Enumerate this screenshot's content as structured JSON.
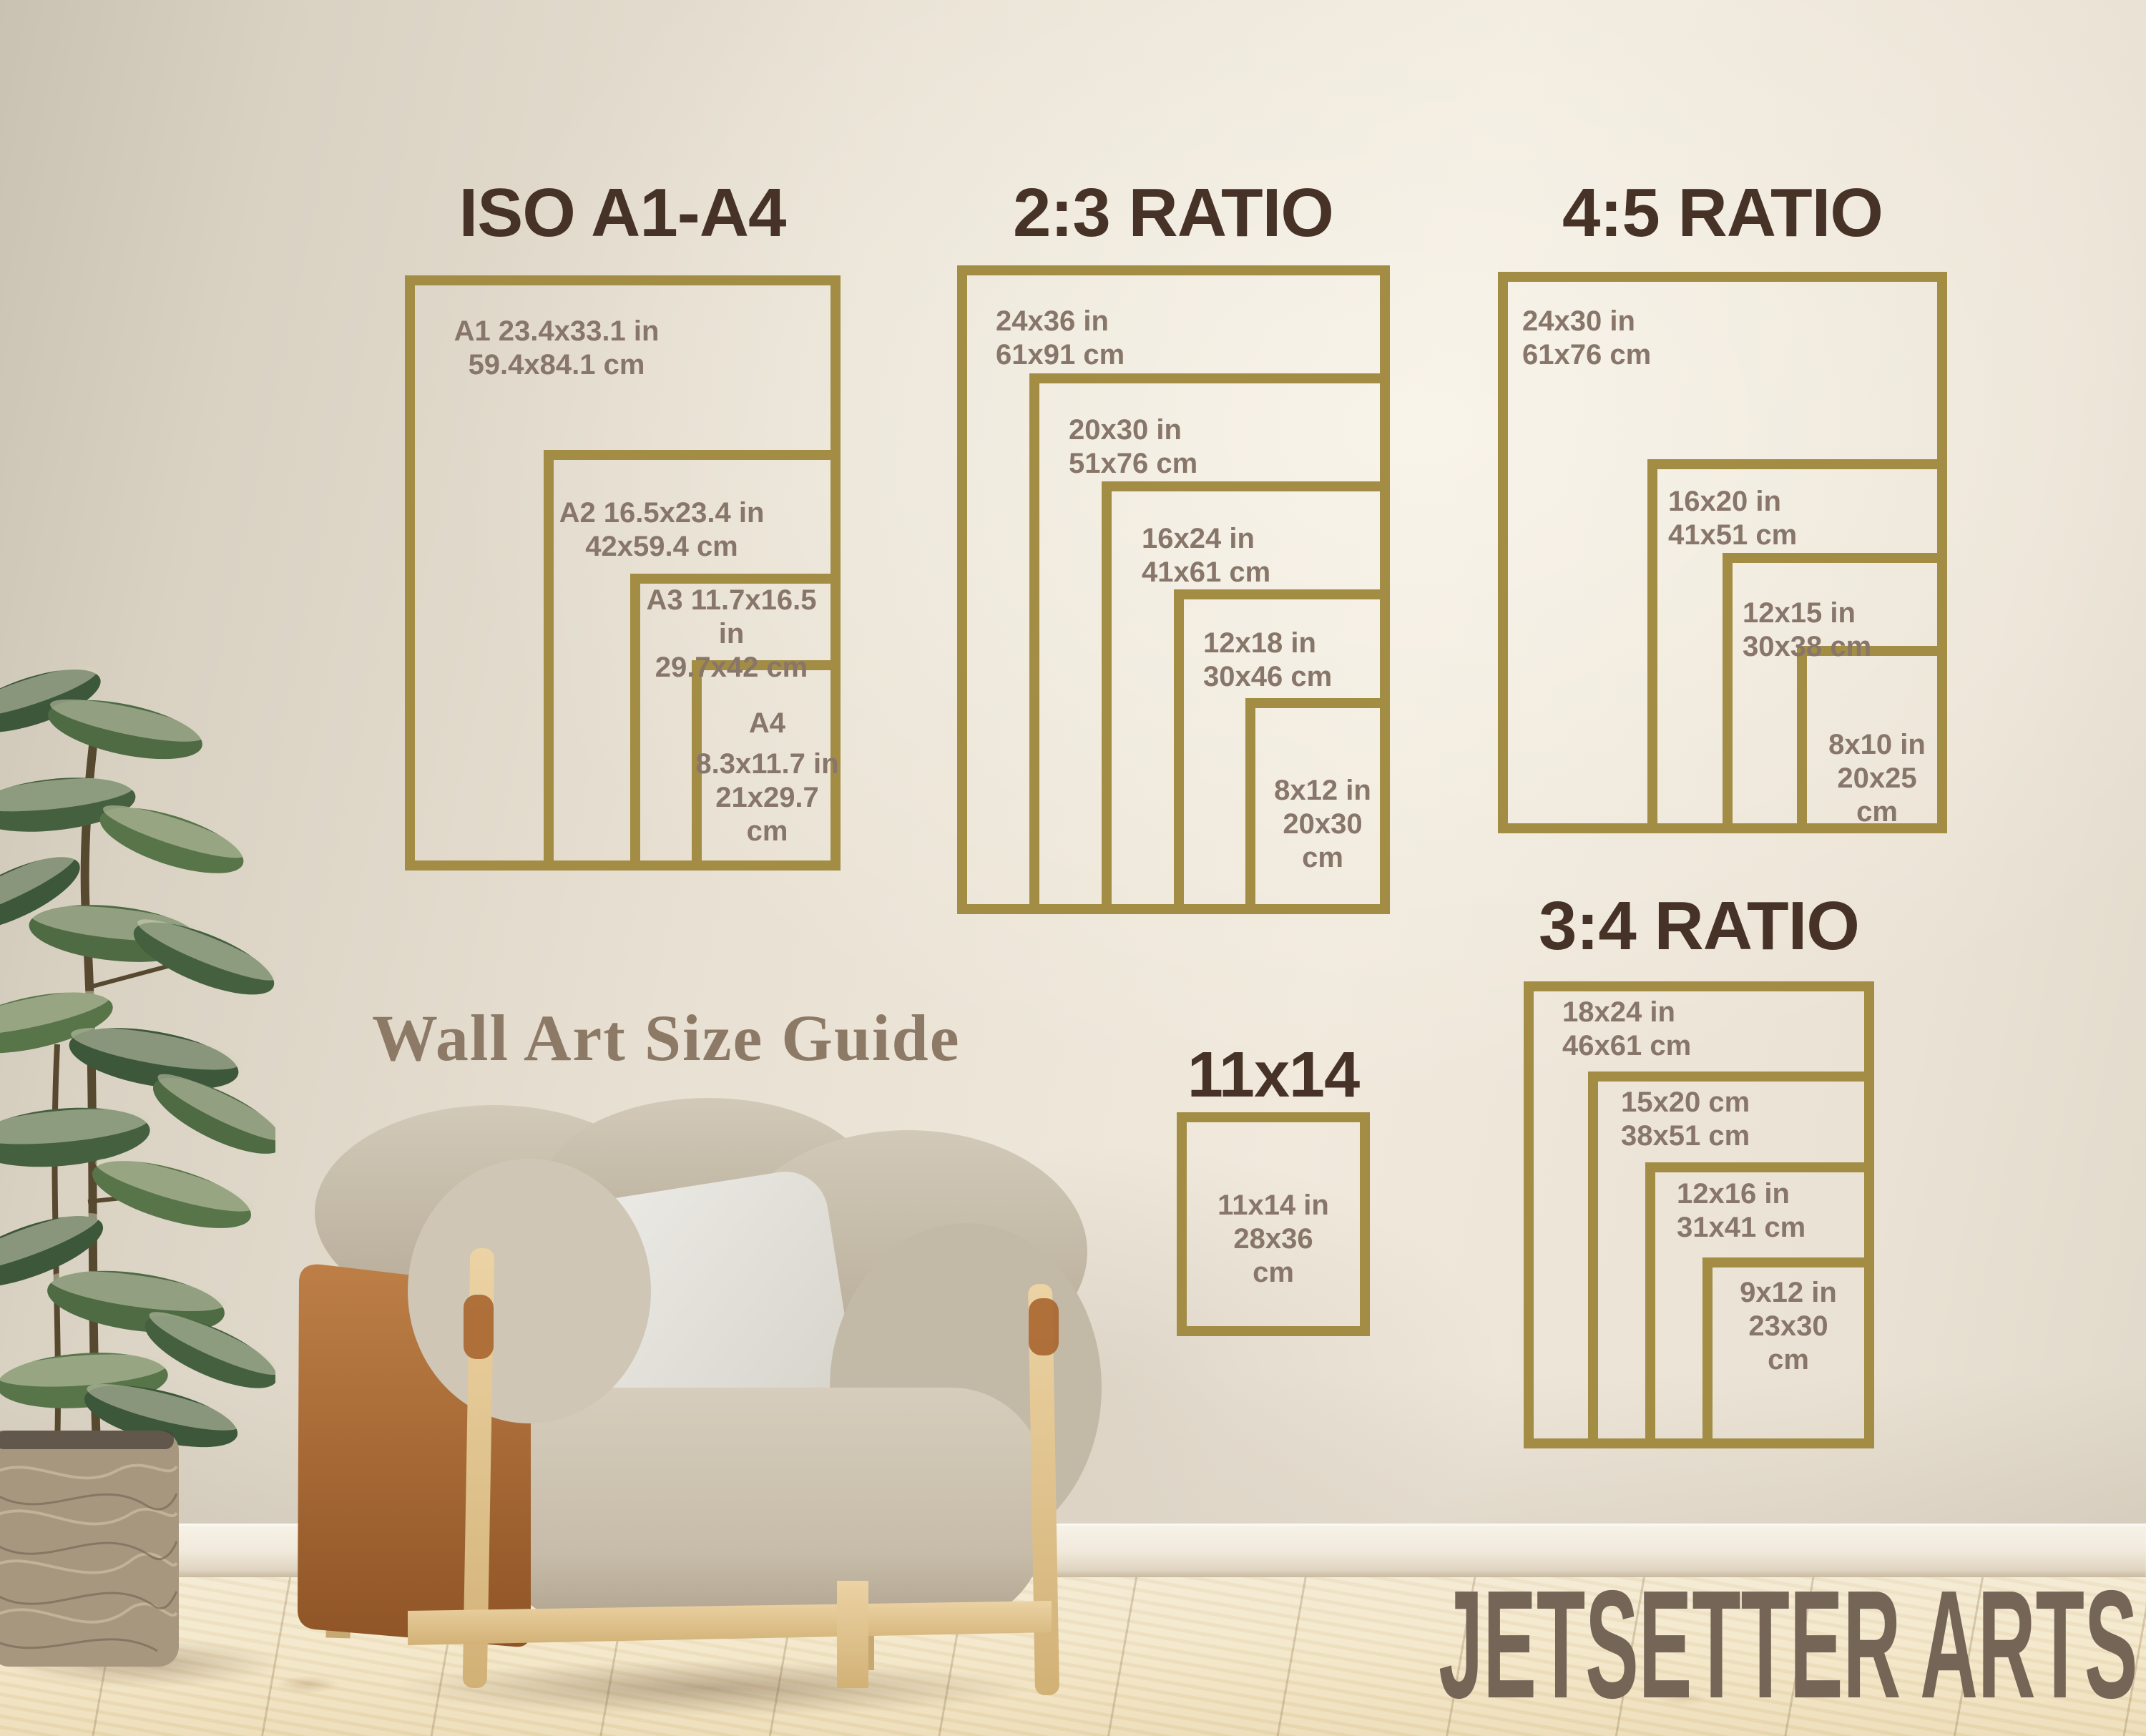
{
  "subtitle": "Wall Art Size Guide",
  "watermark": "JETSETTER ARTS",
  "colors": {
    "frame_gold": "#a38d45",
    "title_brown": "#463226",
    "label_gray_brown": "#877669",
    "subtitle_brown": "#8c7a67",
    "watermark_taupe": "#756557",
    "wall_beige": "#eae3d5",
    "floor_wood": "#f0e2c2",
    "leather_tan": "#b5723c",
    "chair_fabric": "#cbc2b1",
    "plant_green": "#44603f"
  },
  "groups": [
    {
      "title": "ISO A1-A4",
      "frames": [
        {
          "lines": [
            "A1 23.4x33.1 in",
            "59.4x84.1 cm"
          ]
        },
        {
          "lines": [
            "A2 16.5x23.4 in",
            "42x59.4 cm"
          ]
        },
        {
          "lines": [
            "A3 11.7x16.5 in",
            "29.7x42 cm"
          ]
        },
        {
          "lines": [
            "A4",
            "8.3x11.7 in",
            "21x29.7",
            "cm"
          ]
        }
      ]
    },
    {
      "title": "2:3 RATIO",
      "frames": [
        {
          "lines": [
            "24x36 in",
            "61x91 cm"
          ]
        },
        {
          "lines": [
            "20x30 in",
            "51x76 cm"
          ]
        },
        {
          "lines": [
            "16x24 in",
            "41x61 cm"
          ]
        },
        {
          "lines": [
            "12x18 in",
            "30x46 cm"
          ]
        },
        {
          "lines": [
            "8x12 in",
            "20x30",
            "cm"
          ]
        }
      ]
    },
    {
      "title": "4:5 RATIO",
      "frames": [
        {
          "lines": [
            "24x30 in",
            "61x76 cm"
          ]
        },
        {
          "lines": [
            "16x20 in",
            "41x51 cm"
          ]
        },
        {
          "lines": [
            "12x15 in",
            "30x38 cm"
          ]
        },
        {
          "lines": [
            "8x10 in",
            "20x25",
            "cm"
          ]
        }
      ]
    },
    {
      "title": "3:4 RATIO",
      "frames": [
        {
          "lines": [
            "18x24 in",
            "46x61 cm"
          ]
        },
        {
          "lines": [
            "15x20 cm",
            "38x51 cm"
          ]
        },
        {
          "lines": [
            "12x16 in",
            "31x41 cm"
          ]
        },
        {
          "lines": [
            "9x12 in",
            "23x30",
            "cm"
          ]
        }
      ]
    },
    {
      "title": "11x14",
      "frames": [
        {
          "lines": [
            "11x14 in",
            "28x36",
            "cm"
          ]
        }
      ]
    }
  ]
}
